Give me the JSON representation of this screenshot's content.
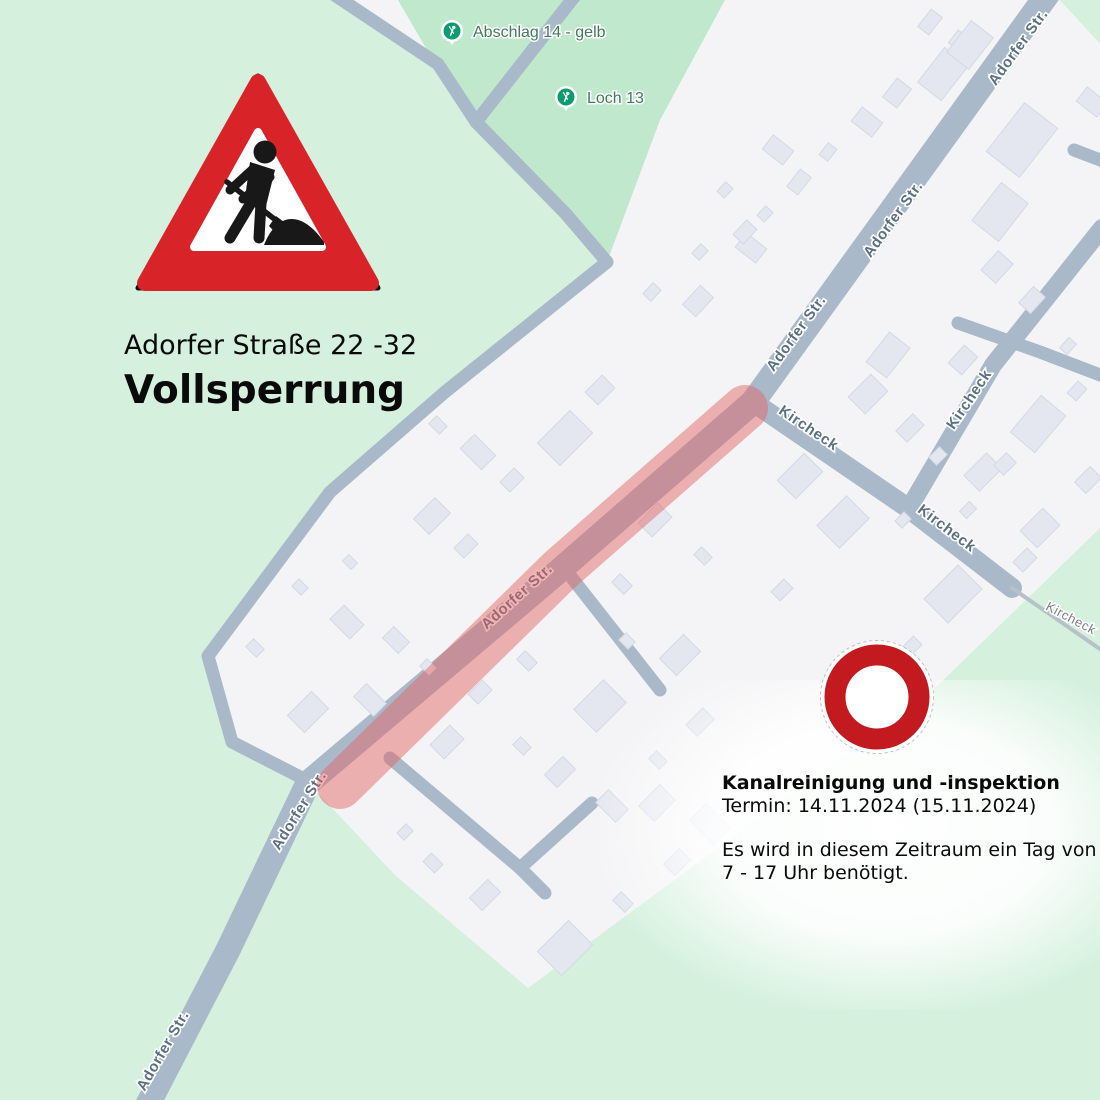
{
  "annotations": {
    "caption_line1": "Adorfer Straße 22 -32",
    "caption_line2": "Vollsperrung",
    "info": {
      "title": "Kanalreinigung und -inspektion",
      "date_line": "Termin: 14.11.2024 (15.11.2024)",
      "body_line1": "Es wird in diesem Zeitraum ein Tag von",
      "body_line2": "7 - 17 Uhr benötigt."
    },
    "signs": [
      "roadworks-warning",
      "no-vehicles"
    ]
  },
  "map": {
    "colors": {
      "background_white": "#f4f4f6",
      "green_light": "#d5f1de",
      "green_golf": "#bfe8cd",
      "road": "#aab9ca",
      "path": "#b7c1c9",
      "building_fill": "#e4e7ef",
      "building_stroke": "#d4d9e5",
      "closure_overlay": "rgba(227,98,98,0.47)",
      "sign_red": "#d82329",
      "no_entry_red": "#c31a1f",
      "marker_green": "#0e9c6e"
    },
    "green_areas": {
      "left_light": [
        [
          0,
          0
        ],
        [
          330,
          0
        ],
        [
          438,
          64
        ],
        [
          476,
          122
        ],
        [
          607,
          262
        ],
        [
          445,
          392
        ],
        [
          330,
          492
        ],
        [
          208,
          656
        ],
        [
          232,
          742
        ],
        [
          306,
          780
        ],
        [
          228,
          950
        ],
        [
          146,
          1108
        ],
        [
          0,
          1108
        ]
      ],
      "golf_dark": [
        [
          398,
          0
        ],
        [
          725,
          0
        ],
        [
          660,
          120
        ],
        [
          607,
          262
        ],
        [
          476,
          122
        ],
        [
          434,
          62
        ]
      ],
      "bottom_light": [
        [
          146,
          1108
        ],
        [
          228,
          950
        ],
        [
          306,
          780
        ],
        [
          396,
          876
        ],
        [
          528,
          988
        ],
        [
          935,
          688
        ],
        [
          1100,
          528
        ],
        [
          1100,
          1108
        ]
      ],
      "topright_light": [
        [
          1056,
          -4
        ],
        [
          1104,
          -4
        ],
        [
          1104,
          48
        ]
      ]
    },
    "roads": [
      {
        "name": "adorfer-main",
        "pts": [
          [
            1052,
            -12
          ],
          [
            753,
            402
          ],
          [
            560,
            570
          ],
          [
            308,
            783
          ],
          [
            228,
            950
          ],
          [
            146,
            1108
          ]
        ],
        "w": 25
      },
      {
        "name": "kircheck-a",
        "pts": [
          [
            753,
            402
          ],
          [
            908,
            508
          ],
          [
            1012,
            588
          ]
        ],
        "w": 20
      },
      {
        "name": "kircheck-b",
        "pts": [
          [
            1102,
            228
          ],
          [
            993,
            365
          ],
          [
            915,
            498
          ]
        ],
        "w": 18
      },
      {
        "name": "top-a",
        "pts": [
          [
            330,
            -8
          ],
          [
            438,
            64
          ],
          [
            476,
            122
          ]
        ],
        "w": 13
      },
      {
        "name": "top-b",
        "pts": [
          [
            578,
            -8
          ],
          [
            476,
            122
          ]
        ],
        "w": 13
      },
      {
        "name": "top-merged",
        "pts": [
          [
            476,
            122
          ],
          [
            566,
            214
          ],
          [
            607,
            262
          ]
        ],
        "w": 13
      },
      {
        "name": "perimeter",
        "pts": [
          [
            607,
            262
          ],
          [
            445,
            392
          ],
          [
            330,
            492
          ],
          [
            208,
            656
          ],
          [
            232,
            742
          ],
          [
            306,
            780
          ]
        ],
        "w": 13
      },
      {
        "name": "stub-northeast",
        "pts": [
          [
            1074,
            150
          ],
          [
            1108,
            163
          ]
        ],
        "w": 13
      },
      {
        "name": "east-lane",
        "pts": [
          [
            958,
            323
          ],
          [
            1040,
            352
          ],
          [
            1108,
            378
          ]
        ],
        "w": 13
      },
      {
        "name": "stub-middle",
        "pts": [
          [
            572,
            578
          ],
          [
            660,
            690
          ]
        ],
        "w": 13
      },
      {
        "name": "south-lane",
        "pts": [
          [
            390,
            758
          ],
          [
            520,
            868
          ],
          [
            545,
            893
          ]
        ],
        "w": 13
      },
      {
        "name": "south-branch",
        "pts": [
          [
            520,
            868
          ],
          [
            592,
            803
          ]
        ],
        "w": 13
      }
    ],
    "footpaths": [
      {
        "name": "kircheck-path",
        "pts": [
          [
            1012,
            588
          ],
          [
            1110,
            656
          ]
        ],
        "w": 4
      }
    ],
    "closure": {
      "label": "Vollsperrung Adorfer Straße 22-32",
      "pts": [
        [
          745,
          408
        ],
        [
          560,
          570
        ],
        [
          340,
          786
        ]
      ],
      "w": 46
    },
    "buildings": [
      [
        930,
        22,
        22,
        14,
        -52
      ],
      [
        958,
        40,
        16,
        12,
        -52
      ],
      [
        943,
        74,
        44,
        30,
        -52
      ],
      [
        897,
        93,
        24,
        18,
        -52
      ],
      [
        867,
        122,
        18,
        26,
        -52
      ],
      [
        828,
        152,
        15,
        11,
        -52
      ],
      [
        799,
        182,
        22,
        14,
        -52
      ],
      [
        765,
        214,
        13,
        10,
        -47
      ],
      [
        751,
        248,
        18,
        26,
        -52
      ],
      [
        778,
        150,
        18,
        26,
        -52
      ],
      [
        725,
        190,
        13,
        10,
        -47
      ],
      [
        745,
        232,
        20,
        14,
        -47
      ],
      [
        700,
        252,
        13,
        10,
        -47
      ],
      [
        652,
        292,
        15,
        11,
        -47
      ],
      [
        698,
        301,
        26,
        18,
        -47
      ],
      [
        970,
        45,
        40,
        28,
        -52
      ],
      [
        1092,
        102,
        18,
        26,
        -52
      ],
      [
        1022,
        140,
        62,
        42,
        -52
      ],
      [
        1000,
        212,
        48,
        34,
        -52
      ],
      [
        997,
        267,
        26,
        20,
        -48
      ],
      [
        1032,
        300,
        22,
        16,
        -48
      ],
      [
        963,
        360,
        24,
        18,
        -48
      ],
      [
        1068,
        346,
        14,
        10,
        -48
      ],
      [
        1077,
        391,
        16,
        12,
        -48
      ],
      [
        888,
        355,
        38,
        26,
        -52
      ],
      [
        868,
        394,
        32,
        24,
        -45
      ],
      [
        910,
        428,
        24,
        16,
        -45
      ],
      [
        938,
        456,
        15,
        11,
        -45
      ],
      [
        983,
        472,
        32,
        22,
        -45
      ],
      [
        1038,
        424,
        48,
        32,
        -50
      ],
      [
        1088,
        480,
        22,
        16,
        -45
      ],
      [
        1040,
        528,
        32,
        24,
        -45
      ],
      [
        1005,
        464,
        18,
        14,
        -45
      ],
      [
        968,
        510,
        14,
        10,
        -45
      ],
      [
        953,
        594,
        48,
        34,
        -45
      ],
      [
        912,
        646,
        16,
        12,
        -45
      ],
      [
        1025,
        560,
        20,
        14,
        -45
      ],
      [
        800,
        476,
        38,
        26,
        -45
      ],
      [
        843,
        522,
        42,
        32,
        -45
      ],
      [
        782,
        590,
        18,
        13,
        -45
      ],
      [
        903,
        520,
        13,
        10,
        -45
      ],
      [
        565,
        438,
        46,
        32,
        -45
      ],
      [
        600,
        390,
        24,
        18,
        -45
      ],
      [
        512,
        480,
        20,
        14,
        -45
      ],
      [
        478,
        452,
        20,
        30,
        -45
      ],
      [
        438,
        425,
        15,
        11,
        45
      ],
      [
        432,
        516,
        30,
        22,
        -45
      ],
      [
        466,
        546,
        20,
        14,
        -45
      ],
      [
        350,
        562,
        12,
        9,
        45
      ],
      [
        300,
        587,
        13,
        10,
        45
      ],
      [
        347,
        622,
        20,
        28,
        -45
      ],
      [
        396,
        640,
        22,
        16,
        45
      ],
      [
        308,
        712,
        34,
        24,
        -45
      ],
      [
        370,
        700,
        18,
        28,
        -45
      ],
      [
        428,
        667,
        13,
        10,
        45
      ],
      [
        255,
        648,
        15,
        11,
        45
      ],
      [
        655,
        520,
        28,
        20,
        -45
      ],
      [
        703,
        556,
        15,
        11,
        45
      ],
      [
        622,
        584,
        17,
        12,
        45
      ],
      [
        680,
        655,
        34,
        24,
        -45
      ],
      [
        627,
        641,
        13,
        10,
        45
      ],
      [
        600,
        706,
        42,
        32,
        -45
      ],
      [
        527,
        661,
        17,
        12,
        45
      ],
      [
        480,
        692,
        20,
        14,
        -45
      ],
      [
        447,
        742,
        28,
        20,
        -45
      ],
      [
        522,
        746,
        15,
        11,
        45
      ],
      [
        560,
        772,
        26,
        18,
        -45
      ],
      [
        612,
        806,
        18,
        28,
        -45
      ],
      [
        658,
        760,
        15,
        11,
        45
      ],
      [
        700,
        722,
        24,
        16,
        -45
      ],
      [
        657,
        803,
        30,
        22,
        -45
      ],
      [
        710,
        824,
        24,
        34,
        -45
      ],
      [
        565,
        948,
        44,
        34,
        -45
      ],
      [
        485,
        895,
        26,
        18,
        -45
      ],
      [
        433,
        863,
        16,
        12,
        45
      ],
      [
        405,
        832,
        13,
        10,
        -45
      ],
      [
        623,
        902,
        17,
        12,
        45
      ],
      [
        677,
        862,
        22,
        16,
        -45
      ]
    ],
    "street_labels": [
      {
        "text": "Adorfer Str.",
        "x": 1022,
        "y": 50,
        "rot": -54
      },
      {
        "text": "Adorfer Str.",
        "x": 897,
        "y": 222,
        "rot": -54
      },
      {
        "text": "Adorfer Str.",
        "x": 800,
        "y": 336,
        "rot": -54
      },
      {
        "text": "Adorfer Str.",
        "x": 520,
        "y": 600,
        "rot": -42
      },
      {
        "text": "Adorfer Str.",
        "x": 303,
        "y": 813,
        "rot": -58
      },
      {
        "text": "Adorfer Str.",
        "x": 167,
        "y": 1053,
        "rot": -60
      },
      {
        "text": "Kircheck",
        "x": 806,
        "y": 432,
        "rot": 34
      },
      {
        "text": "Kircheck",
        "x": 973,
        "y": 402,
        "rot": -56
      },
      {
        "text": "Kircheck",
        "x": 944,
        "y": 532,
        "rot": 37
      },
      {
        "text": "Kircheck",
        "x": 1069,
        "y": 622,
        "rot": 28,
        "small": true
      }
    ],
    "poi_markers": [
      {
        "label": "Abschlag 14 - gelb",
        "x": 452,
        "y": 31
      },
      {
        "label": "Loch 13",
        "x": 566,
        "y": 97
      }
    ]
  }
}
